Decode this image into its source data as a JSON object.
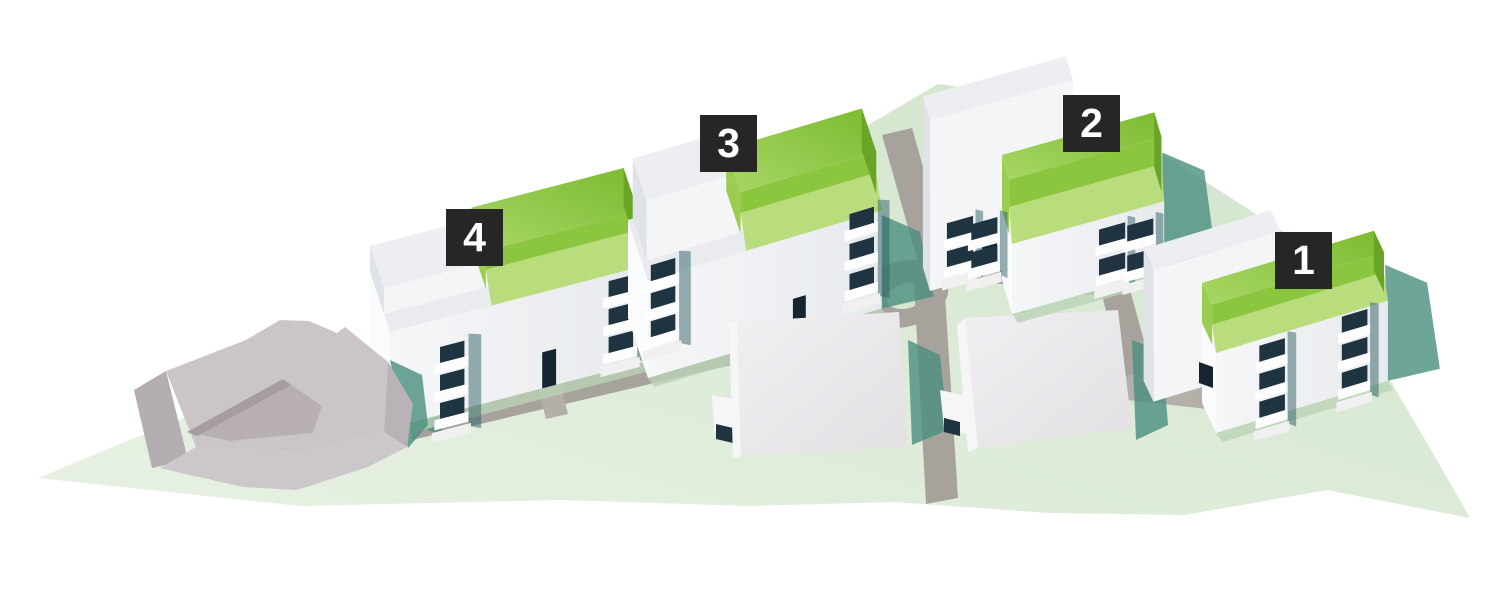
{
  "markers": [
    {
      "label": "4"
    },
    {
      "label": "3"
    },
    {
      "label": "2"
    },
    {
      "label": "1"
    }
  ],
  "colors": {
    "badge_bg": "#262626",
    "badge_text": "#ffffff",
    "cap_top_light": "#a8d766",
    "cap_top_dark": "#7cba30",
    "cap_band": "#b9dd7c",
    "cap_riser": "#8cc63e",
    "cap_side": "#68a527",
    "cap_left": "#9bcd50",
    "wall_front_light": "#f5f6f8",
    "wall_front_dark": "#e7eaed",
    "wall_left": "#fafbfc",
    "wall_top": "#e9ebef",
    "rear_top": "#eceef1",
    "rear_front": "#f4f5f7",
    "rear_left": "#dfe2e6",
    "opening": "#1f3440",
    "door": "#15242e",
    "slab": "#fdfdfd",
    "shadow_teal": "#4a8f80",
    "shadow_deep": "#2e5f66",
    "ground_light": "#e8f1e4",
    "ground_dark": "#d0e4ca",
    "ground_shade": "#b9d3b5",
    "road": "#a8a29c",
    "road_light": "#b5afa9",
    "existing_roof": "#cbc5c8",
    "existing_front": "#ccc7ca",
    "existing_left": "#b4aeb3",
    "existing_right": "#b9b3b8",
    "existing_court": "#b7afb1",
    "fg_roof": "#eceaed",
    "fg_side": "#f6f6f8"
  }
}
